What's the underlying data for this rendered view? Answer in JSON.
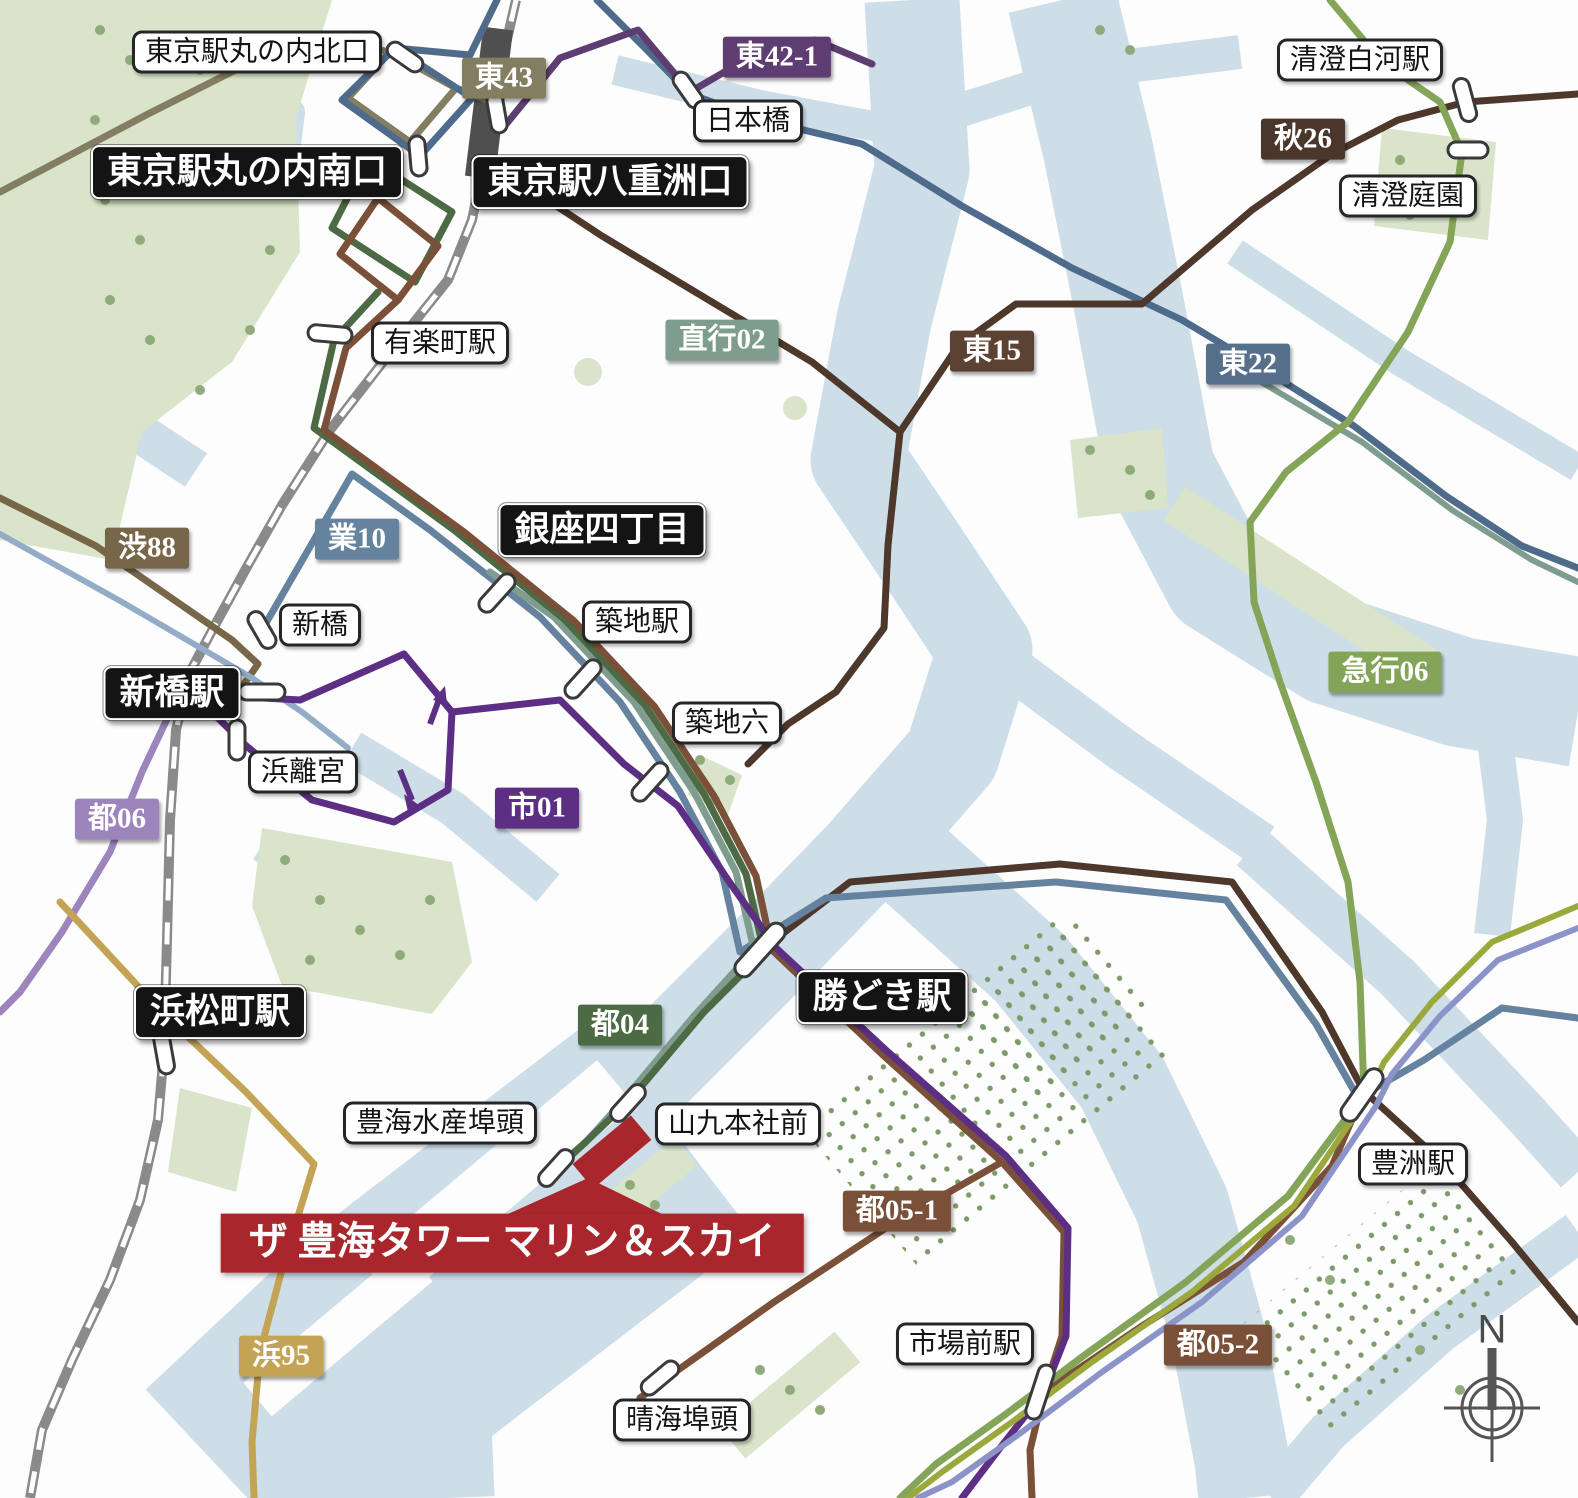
{
  "stations": [
    {
      "label": "東京駅丸の内北口",
      "type": "minor"
    },
    {
      "label": "東京駅丸の内南口",
      "type": "major"
    },
    {
      "label": "東京駅八重洲口",
      "type": "major"
    },
    {
      "label": "日本橋",
      "type": "minor"
    },
    {
      "label": "清澄白河駅",
      "type": "minor"
    },
    {
      "label": "清澄庭園",
      "type": "minor"
    },
    {
      "label": "有楽町駅",
      "type": "minor"
    },
    {
      "label": "銀座四丁目",
      "type": "major"
    },
    {
      "label": "築地駅",
      "type": "minor"
    },
    {
      "label": "築地六",
      "type": "minor"
    },
    {
      "label": "新橋",
      "type": "minor"
    },
    {
      "label": "新橋駅",
      "type": "major"
    },
    {
      "label": "浜離宮",
      "type": "minor"
    },
    {
      "label": "浜松町駅",
      "type": "major"
    },
    {
      "label": "勝どき駅",
      "type": "major"
    },
    {
      "label": "豊海水産埠頭",
      "type": "minor"
    },
    {
      "label": "山九本社前",
      "type": "minor"
    },
    {
      "label": "晴海埠頭",
      "type": "minor"
    },
    {
      "label": "市場前駅",
      "type": "minor"
    },
    {
      "label": "豊洲駅",
      "type": "minor"
    }
  ],
  "route_badges": [
    {
      "label": "東43",
      "color": "#837d62"
    },
    {
      "label": "東42-1",
      "color": "#5d3d72"
    },
    {
      "label": "直行02",
      "color": "#7f9d8e"
    },
    {
      "label": "東15",
      "color": "#5c4232"
    },
    {
      "label": "東22",
      "color": "#56708c"
    },
    {
      "label": "秋26",
      "color": "#4b362c"
    },
    {
      "label": "渋88",
      "color": "#786649"
    },
    {
      "label": "業10",
      "color": "#65829f"
    },
    {
      "label": "急行06",
      "color": "#84a458"
    },
    {
      "label": "都06",
      "color": "#9c84bc"
    },
    {
      "label": "市01",
      "color": "#5c2f85"
    },
    {
      "label": "都04",
      "color": "#4c6a44"
    },
    {
      "label": "都05-1",
      "color": "#7a5038"
    },
    {
      "label": "都05-2",
      "color": "#7a5038"
    },
    {
      "label": "浜95",
      "color": "#c3a455"
    }
  ],
  "property": {
    "label": "ザ 豊海タワー マリン＆スカイ",
    "color": "#a8262c"
  },
  "compass": {
    "label": "N"
  },
  "colors": {
    "water": "#cddee9",
    "park": "#dae4ca",
    "trees": "#8fab7c",
    "railway": "#8a8a8a",
    "station_block": "#4f4f4f",
    "unlabeled_route_yellow_green": "#9aa83c",
    "unlabeled_route_periwinkle": "#8b93c9",
    "unlabeled_route_light_blue": "#93acc8"
  }
}
